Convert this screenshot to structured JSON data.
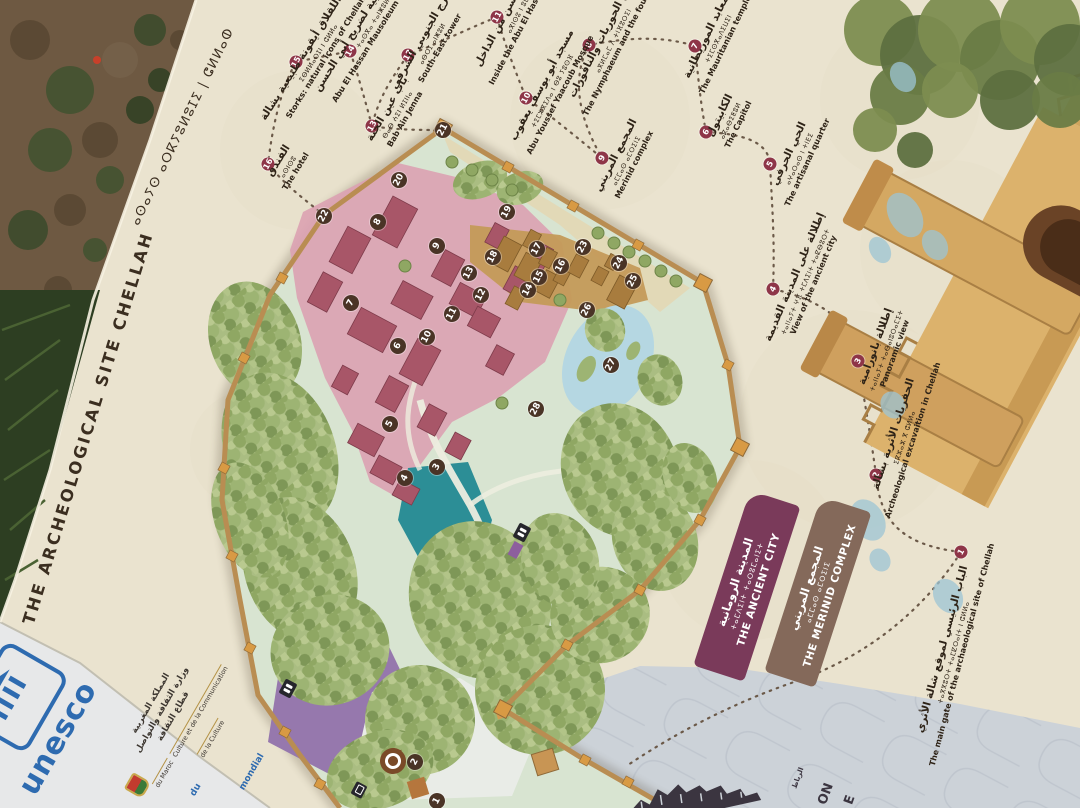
{
  "panel": {
    "title_en": "THE ARCHEOLOGICAL SITE CHELLAH",
    "title_tifinagh": "ⴰⵙⴰⵢⵙ ⴰⵔⴽⵢⵓⵍⵓⵊⵉ | ⵛⵍⵍⴰⵀ"
  },
  "legend": {
    "ancient_city": {
      "ar": "المدينة الرومانية",
      "tifinagh": "ⵜⴰⵎⴷⵉⵏⵜ ⵜⴰⵔⵓⵎⴰⵏⵉⵜ",
      "en": "THE ANCIENT CITY",
      "color": "#7a3a5a"
    },
    "merinid_complex": {
      "ar": "المجمع المريني",
      "tifinagh": "ⴰⵎⵎⴰⵙ ⴰⵎⵔⵉⵏⵉ",
      "en": "THE MERINID COMPLEX",
      "color": "#84695a"
    }
  },
  "route_labels": [
    {
      "id": "main-gate",
      "num": "1",
      "x": 952,
      "y": 652,
      "rot": -75,
      "ar": "الباب الرئيسي لموقع شالة الأثري",
      "tf": "ⵜⴰⴳⴳⵓⵔⵜ ⵜⴰⵎⵇⵔⴰⵏⵜ ⵏ ⵛⵍⵍⴰ",
      "en": "The main gate of the archaeological site of Chellah"
    },
    {
      "id": "excavation",
      "num": "2",
      "x": 903,
      "y": 437,
      "rot": -72,
      "ar": "الحفريات الأثرية بشالة",
      "tf": "ⵉⴽⵣⴰⵣ ⴳ ⵛⵍⵍⴰ",
      "en": "Archeological excavaition in Chellah"
    },
    {
      "id": "panoramic-view",
      "num": "3",
      "x": 885,
      "y": 350,
      "rot": -70,
      "ar": "إطلالة بانورامية",
      "tf": "ⵜⴰⵏⵏⴰⵢⵜ ⵜⴰⴱⴰⵏⵓⵔⴰⵎⵉⵜ",
      "en": "Panoramic view"
    },
    {
      "id": "view-ancient-city",
      "num": "4",
      "x": 804,
      "y": 281,
      "rot": -67,
      "ar": "إطلالة على المدينة القديمة",
      "tf": "ⵜⴰⵏⵏⴰⵢⵜ ⵖⴼ ⵜⵎⴷⵉⵏⵜ ⵜⴰⵇⴱⵓⵔⵜ",
      "en": "View of the ancient city"
    },
    {
      "id": "artisanal-quarter",
      "num": "5",
      "x": 798,
      "y": 158,
      "rot": -65,
      "ar": "الحي الحرفي",
      "tf": "ⴰⵖⴰⵔⴰⵙ ⵏ ⵜⵏⴹⵉ",
      "en": "The artisanal quarter"
    },
    {
      "id": "capitol",
      "num": "6",
      "x": 729,
      "y": 120,
      "rot": -64,
      "ar": "الكابيتول",
      "tf": "ⴰⴽⴰⴱⵉⵟⵓⵍ",
      "en": "The Capitol"
    },
    {
      "id": "mauritanian-temples",
      "num": "7",
      "x": 717,
      "y": 38,
      "rot": -64,
      "ar": "المعابد الموريطانية",
      "tf": "ⵜⵉⵎⵙⴳⴰⴷⵉⵡⵉⵏ",
      "en": "The Mauritanian temples"
    },
    {
      "id": "nymphaeum",
      "num": "8",
      "x": 612,
      "y": 40,
      "rot": -63,
      "ar": "حوض الحوريات والنافورات",
      "tf": "ⴰⴳⵍⵎⴰⵎ ⴷ ⵜⵏⴼⵓⵔⵉⵏ",
      "en": "The Nymphaeum and the fountains"
    },
    {
      "id": "merinid-complex",
      "num": "9",
      "x": 625,
      "y": 160,
      "rot": -63,
      "ar": "المجمع المريني",
      "tf": "ⴰⵎⵎⴰⵙ ⴰⵎⵔⵉⵏⵉ",
      "en": "Merinid complex"
    },
    {
      "id": "abu-youssef-mosque",
      "num": "10",
      "x": 551,
      "y": 90,
      "rot": -62,
      "ar": "مسجد أبو يوسف يعقوب",
      "tf": "ⵜⵉⵎⵣⴳⵉⴷⴰ ⵏ ⴱⵓ ⵢⵓⵙⴼ",
      "en": "Abu Youssef Yaacoub Mosque"
    },
    {
      "id": "inside-mausoleum",
      "num": "11",
      "x": 521,
      "y": 6,
      "rot": -62,
      "ar": "ضريح أبي الحسن من الداخل",
      "tf": "ⴰⴳⵏⵙⵓ ⵏ ⵓⵎⴹⴹⴰⵍ",
      "en": "Inside the Abu El Hassan Mausoleum"
    },
    {
      "id": "south-east-tower",
      "num": "12",
      "x": 431,
      "y": 43,
      "rot": -60,
      "ar": "البرج الجنوبي الشرقي",
      "tf": "ⴰⴱⵔⵊ ⴰⵏⵥⵓⵍ",
      "en": "South-East tower"
    },
    {
      "id": "bab-ain-jenna",
      "num": "13",
      "x": 396,
      "y": 114,
      "rot": -60,
      "ar": "باب عين الجنة",
      "tf": "ⴱⴰⴱ ⵄⵉⵏ ⵍⵊⵏⵏⴰ",
      "en": "Bab Ain Jenna"
    },
    {
      "id": "mausoleum-facade",
      "num": "14",
      "x": 373,
      "y": 20,
      "rot": -58,
      "ar": "الواجهة الجنوبية لضريح أبي الحسن",
      "tf": "ⵜⴰⵙⴳⴰ ⵜⴰⵏⵥⵓⵍⵜ",
      "en": "Abu El Hassan Mausoleum south façade"
    },
    {
      "id": "storks",
      "num": "15",
      "x": 317,
      "y": 52,
      "rot": -58,
      "ar": "طائر اللقلاق أيقونة طبيعية بشالة",
      "tf": "ⵉⴱⵍⵍⴰⵔⵊⵏ ⵏ ⵛⵍⵍⴰ",
      "en": "Storks: natural icons of Chellah"
    },
    {
      "id": "hotel",
      "num": "16",
      "x": 287,
      "y": 166,
      "rot": -58,
      "ar": "الفندق",
      "tf": "ⴰⵙⵏⵙⵓ",
      "en": "The hotel"
    }
  ],
  "route_markers": [
    {
      "num": "1",
      "x": 961,
      "y": 552
    },
    {
      "num": "2",
      "x": 876,
      "y": 475
    },
    {
      "num": "3",
      "x": 858,
      "y": 361
    },
    {
      "num": "4",
      "x": 773,
      "y": 289
    },
    {
      "num": "5",
      "x": 770,
      "y": 164
    },
    {
      "num": "6",
      "x": 706,
      "y": 132
    },
    {
      "num": "7",
      "x": 695,
      "y": 46
    },
    {
      "num": "8",
      "x": 589,
      "y": 45
    },
    {
      "num": "9",
      "x": 602,
      "y": 158
    },
    {
      "num": "10",
      "x": 526,
      "y": 98
    },
    {
      "num": "11",
      "x": 497,
      "y": 17
    },
    {
      "num": "12",
      "x": 408,
      "y": 55
    },
    {
      "num": "13",
      "x": 372,
      "y": 126
    },
    {
      "num": "14",
      "x": 350,
      "y": 51
    },
    {
      "num": "15",
      "x": 296,
      "y": 62
    },
    {
      "num": "16",
      "x": 268,
      "y": 164
    }
  ],
  "map_markers": [
    {
      "num": "1",
      "x": 437,
      "y": 801
    },
    {
      "num": "2",
      "x": 415,
      "y": 762
    },
    {
      "num": "3",
      "x": 437,
      "y": 467
    },
    {
      "num": "4",
      "x": 405,
      "y": 478
    },
    {
      "num": "5",
      "x": 390,
      "y": 424
    },
    {
      "num": "6",
      "x": 398,
      "y": 346
    },
    {
      "num": "7",
      "x": 351,
      "y": 303
    },
    {
      "num": "8",
      "x": 378,
      "y": 222
    },
    {
      "num": "9",
      "x": 437,
      "y": 246
    },
    {
      "num": "10",
      "x": 427,
      "y": 337
    },
    {
      "num": "11",
      "x": 452,
      "y": 314
    },
    {
      "num": "12",
      "x": 481,
      "y": 295
    },
    {
      "num": "13",
      "x": 469,
      "y": 273
    },
    {
      "num": "14",
      "x": 528,
      "y": 290
    },
    {
      "num": "15",
      "x": 539,
      "y": 277
    },
    {
      "num": "16",
      "x": 561,
      "y": 266
    },
    {
      "num": "17",
      "x": 537,
      "y": 249
    },
    {
      "num": "18",
      "x": 493,
      "y": 257
    },
    {
      "num": "19",
      "x": 507,
      "y": 212
    },
    {
      "num": "20",
      "x": 399,
      "y": 180
    },
    {
      "num": "21",
      "x": 443,
      "y": 130
    },
    {
      "num": "22",
      "x": 324,
      "y": 216
    },
    {
      "num": "23",
      "x": 583,
      "y": 247
    },
    {
      "num": "24",
      "x": 619,
      "y": 263
    },
    {
      "num": "25",
      "x": 633,
      "y": 281
    },
    {
      "num": "26",
      "x": 587,
      "y": 310
    },
    {
      "num": "27",
      "x": 611,
      "y": 365
    },
    {
      "num": "28",
      "x": 536,
      "y": 409
    }
  ],
  "credits": {
    "unesco_wordmark": "unesco",
    "convention_fragment_line1": "du",
    "convention_fragment_line2": "mondial",
    "ministry_ar_line1": "المملكة المغربية",
    "ministry_ar_line2": "وزارة الثقافة والتواصل",
    "ministry_ar_line3": "قطاع الثقافة",
    "ministry_fr_line1": "du Maroc",
    "ministry_fr_line2": "Culture et de la Communication",
    "ministry_fr_line3": "de la Culture"
  },
  "rabat_logo": {
    "ar": "الرباط",
    "fragment1": "ON",
    "fragment2": "E"
  },
  "colors": {
    "panel_cream": "#eae3cf",
    "map_lawn": "#d8e4d1",
    "ancient_city_zone": "#dba3b2",
    "ancient_city_ruins": "#a85668",
    "merinid_zone": "#c49a58",
    "pond_teal": "#2c8e96",
    "pond_light_blue": "#b5d7e2",
    "parking_purple": "#9678ad",
    "wall_tan": "#b98d52",
    "gate_orange": "#d89a44",
    "marker_brown": "#4a3426",
    "marker_maroon": "#8e3548",
    "pattern_zone_gray": "#ccd2d8",
    "unesco_blue": "#2e6bb0"
  }
}
